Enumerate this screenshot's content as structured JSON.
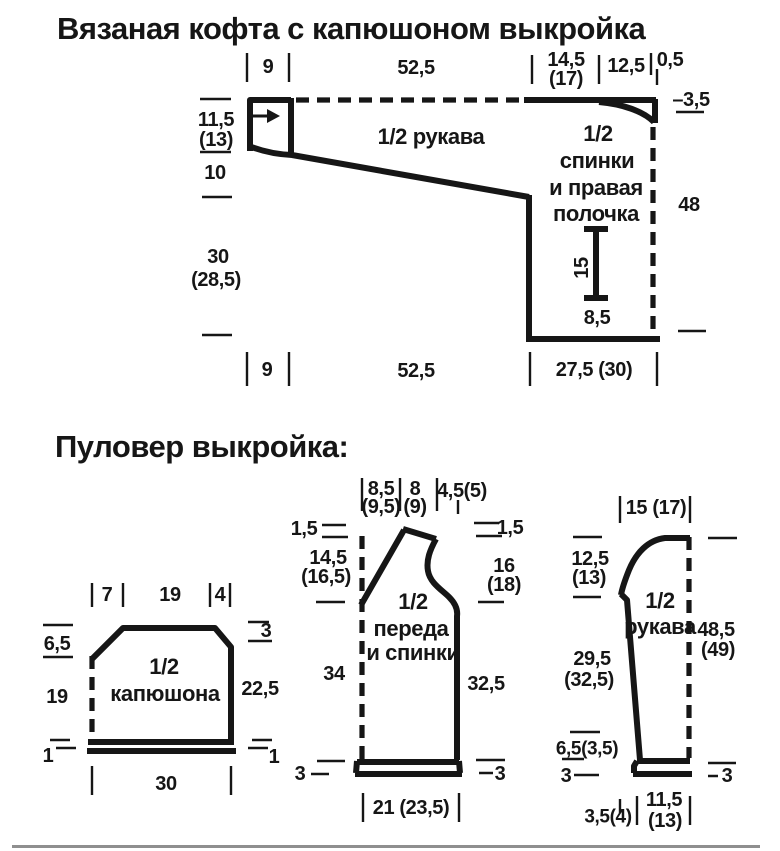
{
  "page": {
    "title_cardigan": "Вязаная кофта с капюшоном выкройка",
    "title_pullover": "Пуловер выкройка:",
    "bg_color": "#ffffff",
    "ink_color": "#161616",
    "divider_color": "#8f8f8f"
  },
  "cardigan": {
    "piece_names": [
      "1/2 рукава",
      "1/2 спинки и правая полочка"
    ],
    "labels": [
      {
        "n": "dim-cuff-width-top",
        "t": "9",
        "x": 268,
        "y": 67
      },
      {
        "n": "dim-sleeve-length-top",
        "t": "52,5",
        "x": 416,
        "y": 68
      },
      {
        "n": "dim-back-width",
        "t": "14,5",
        "x": 566,
        "y": 60
      },
      {
        "n": "dim-back-width-alt",
        "t": "(17)",
        "x": 566,
        "y": 79
      },
      {
        "n": "dim-shoulder-width",
        "t": "12,5",
        "x": 626,
        "y": 66
      },
      {
        "n": "dim-neck-step",
        "t": "0,5",
        "x": 670,
        "y": 60
      },
      {
        "n": "dim-cuff-height",
        "t": "11,5",
        "x": 216,
        "y": 120
      },
      {
        "n": "dim-cuff-height-alt",
        "t": "(13)",
        "x": 216,
        "y": 140
      },
      {
        "n": "dim-slope-height",
        "t": "10",
        "x": 215,
        "y": 173
      },
      {
        "n": "dim-side-height",
        "t": "30",
        "x": 218,
        "y": 257
      },
      {
        "n": "dim-side-height-alt",
        "t": "(28,5)",
        "x": 216,
        "y": 280
      },
      {
        "n": "dim-cuff-width-bottom",
        "t": "9",
        "x": 267,
        "y": 370
      },
      {
        "n": "dim-sleeve-length-bottom",
        "t": "52,5",
        "x": 416,
        "y": 371
      },
      {
        "n": "dim-body-width-bottom",
        "t": "27,5 (30)",
        "x": 594,
        "y": 370
      },
      {
        "n": "dim-neck-drop",
        "t": "–3,5",
        "x": 691,
        "y": 100
      },
      {
        "n": "dim-body-height",
        "t": "48",
        "x": 689,
        "y": 205
      },
      {
        "n": "label-sleeve",
        "t": "1/2 рукава",
        "x": 431,
        "y": 137,
        "fs": 22
      },
      {
        "n": "label-body-line1",
        "t": "1/2",
        "x": 598,
        "y": 134,
        "fs": 22
      },
      {
        "n": "label-body-line2",
        "t": "спинки",
        "x": 597,
        "y": 161,
        "fs": 22
      },
      {
        "n": "label-body-line3",
        "t": "и правая",
        "x": 596,
        "y": 188,
        "fs": 22
      },
      {
        "n": "label-body-line4",
        "t": "полочка",
        "x": 596,
        "y": 214,
        "fs": 22
      },
      {
        "n": "dim-pocket-height",
        "t": "15",
        "x": 582,
        "y": 268,
        "r": -90
      },
      {
        "n": "dim-pocket-offset",
        "t": "8,5",
        "x": 597,
        "y": 318
      }
    ]
  },
  "hood": {
    "piece_names": [
      "1/2 капюшона"
    ],
    "labels": [
      {
        "n": "dim-top-left",
        "t": "7",
        "x": 107,
        "y": 595
      },
      {
        "n": "dim-top-middle",
        "t": "19",
        "x": 170,
        "y": 595
      },
      {
        "n": "dim-top-right",
        "t": "4",
        "x": 220,
        "y": 595
      },
      {
        "n": "dim-corner-left",
        "t": "6,5",
        "x": 57,
        "y": 644
      },
      {
        "n": "dim-left-height",
        "t": "19",
        "x": 57,
        "y": 697
      },
      {
        "n": "dim-corner-right",
        "t": "3",
        "x": 266,
        "y": 631
      },
      {
        "n": "dim-right-height",
        "t": "22,5",
        "x": 260,
        "y": 689
      },
      {
        "n": "dim-band-left",
        "t": "1",
        "x": 48,
        "y": 756
      },
      {
        "n": "dim-band-right",
        "t": "1",
        "x": 274,
        "y": 757
      },
      {
        "n": "dim-bottom-width",
        "t": "30",
        "x": 166,
        "y": 784
      },
      {
        "n": "label-piece-line1",
        "t": "1/2",
        "x": 164,
        "y": 667,
        "fs": 22
      },
      {
        "n": "label-piece-line2",
        "t": "капюшона",
        "x": 165,
        "y": 694,
        "fs": 22
      }
    ]
  },
  "pullover_body": {
    "piece_names": [
      "1/2 переда и спинки"
    ],
    "labels": [
      {
        "n": "dim-top-neck",
        "t": "8,5",
        "x": 381,
        "y": 489
      },
      {
        "n": "dim-top-neck-alt",
        "t": "(9,5)",
        "x": 381,
        "y": 507
      },
      {
        "n": "dim-top-shoulder",
        "t": "8",
        "x": 415,
        "y": 489
      },
      {
        "n": "dim-top-shoulder-alt",
        "t": "(9)",
        "x": 415,
        "y": 507
      },
      {
        "n": "dim-top-armhole",
        "t": "4,5(5)",
        "x": 462,
        "y": 491
      },
      {
        "n": "dim-shoulder-drop-left",
        "t": "1,5",
        "x": 304,
        "y": 529
      },
      {
        "n": "dim-neck-depth",
        "t": "14,5",
        "x": 328,
        "y": 558
      },
      {
        "n": "dim-neck-depth-alt",
        "t": "(16,5)",
        "x": 326,
        "y": 577
      },
      {
        "n": "dim-side-left",
        "t": "34",
        "x": 334,
        "y": 674
      },
      {
        "n": "dim-band-left",
        "t": "3",
        "x": 300,
        "y": 774
      },
      {
        "n": "dim-shoulder-drop-right",
        "t": "1,5",
        "x": 510,
        "y": 528
      },
      {
        "n": "dim-armhole-height",
        "t": "16",
        "x": 504,
        "y": 566
      },
      {
        "n": "dim-armhole-height-alt",
        "t": "(18)",
        "x": 504,
        "y": 585
      },
      {
        "n": "dim-side-right",
        "t": "32,5",
        "x": 486,
        "y": 684
      },
      {
        "n": "dim-band-right",
        "t": "3",
        "x": 500,
        "y": 774
      },
      {
        "n": "dim-bottom-width",
        "t": "21 (23,5)",
        "x": 411,
        "y": 808
      },
      {
        "n": "label-piece-line1",
        "t": "1/2",
        "x": 413,
        "y": 602,
        "fs": 22
      },
      {
        "n": "label-piece-line2",
        "t": "переда",
        "x": 411,
        "y": 629,
        "fs": 22
      },
      {
        "n": "label-piece-line3",
        "t": "и спинки",
        "x": 413,
        "y": 653,
        "fs": 22
      }
    ]
  },
  "pullover_sleeve": {
    "piece_names": [
      "1/2 рукава"
    ],
    "labels": [
      {
        "n": "dim-top-width",
        "t": "15 (17)",
        "x": 656,
        "y": 508
      },
      {
        "n": "dim-cap-height",
        "t": "12,5",
        "x": 590,
        "y": 559
      },
      {
        "n": "dim-cap-height-alt",
        "t": "(13)",
        "x": 589,
        "y": 578
      },
      {
        "n": "dim-underarm-length",
        "t": "29,5",
        "x": 592,
        "y": 659
      },
      {
        "n": "dim-underarm-length-alt",
        "t": "(32,5)",
        "x": 589,
        "y": 680
      },
      {
        "n": "dim-full-length",
        "t": "48,5",
        "x": 716,
        "y": 630
      },
      {
        "n": "dim-full-length-alt",
        "t": "(49)",
        "x": 718,
        "y": 650
      },
      {
        "n": "dim-cuff-note",
        "t": "6,5(3,5)",
        "x": 587,
        "y": 749,
        "fs": 19
      },
      {
        "n": "dim-band-left",
        "t": "3",
        "x": 566,
        "y": 776
      },
      {
        "n": "dim-band-right",
        "t": "3",
        "x": 727,
        "y": 776
      },
      {
        "n": "dim-bottom-offset",
        "t": "3,5(4)",
        "x": 608,
        "y": 817,
        "fs": 19
      },
      {
        "n": "dim-cuff-width",
        "t": "11,5",
        "x": 664,
        "y": 800
      },
      {
        "n": "dim-cuff-width-alt",
        "t": "(13)",
        "x": 665,
        "y": 821
      },
      {
        "n": "label-piece-line1",
        "t": "1/2",
        "x": 660,
        "y": 601,
        "fs": 22
      },
      {
        "n": "label-piece-line2",
        "t": "рукава",
        "x": 660,
        "y": 627,
        "fs": 22
      }
    ]
  }
}
